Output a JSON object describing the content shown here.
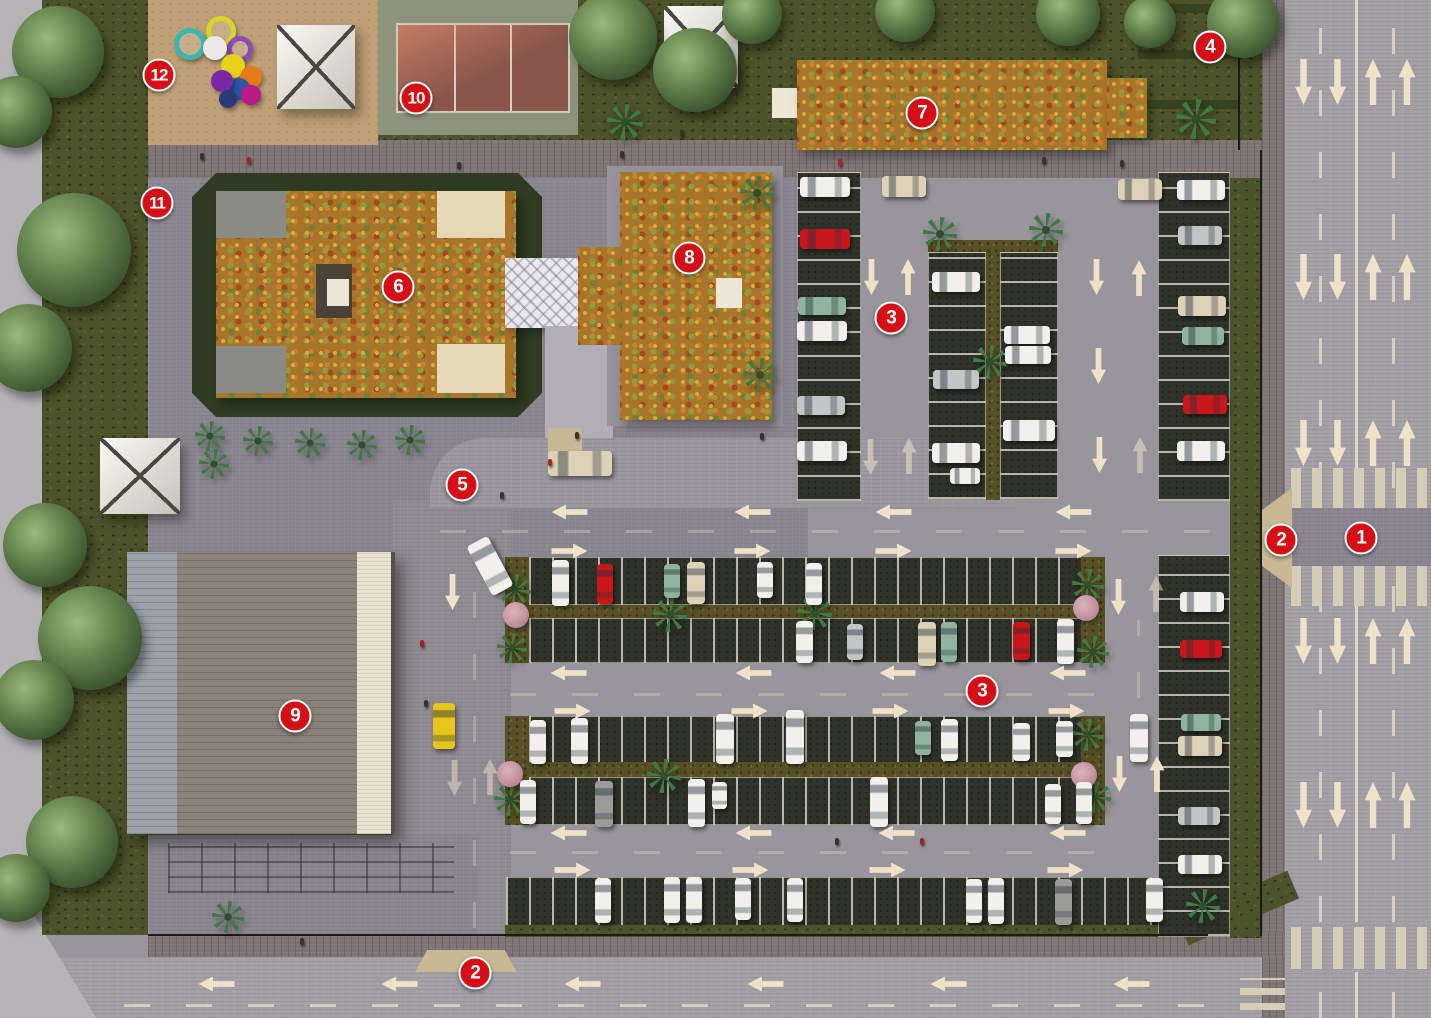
{
  "scene": {
    "width": 1431,
    "height": 1018
  },
  "colors": {
    "marker_red": "#d60e15",
    "road": "#a3a0a6",
    "plaza": "#8b8791",
    "walkway_dark": "#7d7473",
    "sidewalk_light": "#b7b4b8",
    "grass_dark": "#4c5229",
    "stall_surface": "#2f3329",
    "stall_line": "#b9b6ae",
    "arrow_cream": "#efe2c8",
    "flower_roof_base": "#a8762a",
    "building9_roof": "#8a8179",
    "canopy_white": "#efede7",
    "court_red": "#8a564b",
    "court_surround": "#8e937c",
    "sand": "#bfa077",
    "median_olive": "#575026",
    "ramp_tan": "#c9b894",
    "car_white": "#f1f0ed",
    "car_red": "#c9161a",
    "car_teal": "#8fb49f",
    "car_silver": "#c3c5c7",
    "car_gray": "#9b9b99",
    "car_beige": "#ddd2b8",
    "taxi_yellow": "#e7c51c"
  },
  "markers": [
    {
      "n": "1",
      "x": 1361,
      "y": 538
    },
    {
      "n": "2",
      "x": 1281,
      "y": 540
    },
    {
      "n": "2",
      "x": 475,
      "y": 973
    },
    {
      "n": "3",
      "x": 891,
      "y": 318
    },
    {
      "n": "3",
      "x": 982,
      "y": 691
    },
    {
      "n": "4",
      "x": 1210,
      "y": 47
    },
    {
      "n": "5",
      "x": 462,
      "y": 485
    },
    {
      "n": "6",
      "x": 398,
      "y": 287
    },
    {
      "n": "7",
      "x": 922,
      "y": 113
    },
    {
      "n": "8",
      "x": 689,
      "y": 258
    },
    {
      "n": "9",
      "x": 295,
      "y": 716
    },
    {
      "n": "10",
      "x": 416,
      "y": 98
    },
    {
      "n": "11",
      "x": 157,
      "y": 203
    },
    {
      "n": "12",
      "x": 159,
      "y": 75
    }
  ],
  "arrows": {
    "fields": [
      "dir",
      "cx",
      "cy",
      "kind",
      "opacity"
    ],
    "items": [
      [
        "down",
        1303,
        82,
        "road",
        1
      ],
      [
        "down",
        1337,
        82,
        "road",
        1
      ],
      [
        "up",
        1373,
        82,
        "road",
        1
      ],
      [
        "up",
        1407,
        82,
        "road",
        1
      ],
      [
        "down",
        1303,
        277,
        "road",
        1
      ],
      [
        "down",
        1337,
        277,
        "road",
        1
      ],
      [
        "up",
        1373,
        277,
        "road",
        1
      ],
      [
        "up",
        1407,
        277,
        "road",
        1
      ],
      [
        "down",
        1303,
        443,
        "road",
        1
      ],
      [
        "down",
        1337,
        443,
        "road",
        1
      ],
      [
        "up",
        1373,
        443,
        "road",
        1
      ],
      [
        "up",
        1407,
        443,
        "road",
        1
      ],
      [
        "down",
        1303,
        641,
        "road",
        1
      ],
      [
        "down",
        1337,
        641,
        "road",
        1
      ],
      [
        "up",
        1373,
        641,
        "road",
        1
      ],
      [
        "up",
        1407,
        641,
        "road",
        1
      ],
      [
        "down",
        1303,
        805,
        "road",
        1
      ],
      [
        "down",
        1337,
        805,
        "road",
        1
      ],
      [
        "up",
        1373,
        805,
        "road",
        1
      ],
      [
        "up",
        1407,
        805,
        "road",
        1
      ],
      [
        "left",
        216,
        984,
        "lot",
        1
      ],
      [
        "left",
        399,
        984,
        "lot",
        1
      ],
      [
        "left",
        582,
        984,
        "lot",
        1
      ],
      [
        "left",
        765,
        984,
        "lot",
        1
      ],
      [
        "left",
        948,
        984,
        "lot",
        1
      ],
      [
        "left",
        1131,
        984,
        "lot",
        1
      ],
      [
        "left",
        569,
        512,
        "lot",
        1
      ],
      [
        "left",
        752,
        512,
        "lot",
        1
      ],
      [
        "left",
        893,
        512,
        "lot",
        1
      ],
      [
        "left",
        1073,
        512,
        "lot",
        1
      ],
      [
        "right",
        569,
        551,
        "lot",
        1
      ],
      [
        "right",
        752,
        551,
        "lot",
        1
      ],
      [
        "right",
        893,
        551,
        "lot",
        1
      ],
      [
        "right",
        1073,
        551,
        "lot",
        1
      ],
      [
        "left",
        568,
        673,
        "lot",
        1
      ],
      [
        "left",
        753,
        673,
        "lot",
        1
      ],
      [
        "left",
        897,
        673,
        "lot",
        1
      ],
      [
        "left",
        1067,
        673,
        "lot",
        1
      ],
      [
        "right",
        572,
        711,
        "lot",
        1
      ],
      [
        "right",
        749,
        711,
        "lot",
        1
      ],
      [
        "right",
        890,
        711,
        "lot",
        1
      ],
      [
        "right",
        1066,
        711,
        "lot",
        1
      ],
      [
        "left",
        568,
        833,
        "lot",
        1
      ],
      [
        "left",
        753,
        833,
        "lot",
        1
      ],
      [
        "left",
        896,
        833,
        "lot",
        1
      ],
      [
        "left",
        1067,
        833,
        "lot",
        1
      ],
      [
        "right",
        572,
        870,
        "lot",
        1
      ],
      [
        "right",
        750,
        870,
        "lot",
        1
      ],
      [
        "right",
        887,
        870,
        "lot",
        1
      ],
      [
        "right",
        1065,
        870,
        "lot",
        1
      ],
      [
        "down",
        452,
        592,
        "lot",
        1
      ],
      [
        "down",
        454,
        778,
        "lot",
        0.5
      ],
      [
        "up",
        490,
        777,
        "lot",
        0.5
      ],
      [
        "down",
        871,
        277,
        "lot",
        1
      ],
      [
        "up",
        908,
        277,
        "lot",
        1
      ],
      [
        "down",
        870,
        457,
        "lot",
        0.55
      ],
      [
        "up",
        909,
        456,
        "lot",
        0.55
      ],
      [
        "down",
        1096,
        277,
        "lot",
        1
      ],
      [
        "up",
        1139,
        278,
        "lot",
        1
      ],
      [
        "down",
        1098,
        366,
        "lot",
        1
      ],
      [
        "down",
        1099,
        455,
        "lot",
        1
      ],
      [
        "up",
        1140,
        455,
        "lot",
        0.55
      ],
      [
        "down",
        1118,
        597,
        "lot",
        1
      ],
      [
        "up",
        1156,
        594,
        "lot",
        0.5
      ],
      [
        "down",
        1119,
        774,
        "lot",
        1
      ],
      [
        "up",
        1157,
        774,
        "lot",
        1
      ]
    ]
  },
  "cars": {
    "fields": [
      "x",
      "y",
      "w",
      "h",
      "color",
      "rotate"
    ],
    "items": [
      [
        800,
        177,
        50,
        20,
        "white",
        0
      ],
      [
        800,
        229,
        50,
        20,
        "red",
        0
      ],
      [
        798,
        297,
        48,
        18,
        "teal",
        0
      ],
      [
        797,
        321,
        50,
        20,
        "white",
        0
      ],
      [
        797,
        396,
        48,
        19,
        "silver",
        0
      ],
      [
        797,
        441,
        50,
        20,
        "white",
        0
      ],
      [
        932,
        272,
        48,
        20,
        "white",
        0
      ],
      [
        933,
        370,
        46,
        19,
        "silver",
        0
      ],
      [
        932,
        443,
        48,
        20,
        "white",
        0
      ],
      [
        950,
        468,
        30,
        16,
        "white",
        0
      ],
      [
        1004,
        326,
        46,
        18,
        "white",
        0
      ],
      [
        1005,
        346,
        46,
        18,
        "white",
        0
      ],
      [
        1003,
        420,
        52,
        21,
        "white",
        0
      ],
      [
        1177,
        180,
        48,
        20,
        "white",
        0
      ],
      [
        1178,
        226,
        44,
        19,
        "silver",
        0
      ],
      [
        1178,
        296,
        48,
        20,
        "beige",
        0
      ],
      [
        1182,
        327,
        42,
        18,
        "teal",
        0
      ],
      [
        1183,
        395,
        44,
        19,
        "red",
        0
      ],
      [
        1177,
        441,
        48,
        20,
        "white",
        0
      ],
      [
        882,
        176,
        44,
        21,
        "beige",
        0
      ],
      [
        1118,
        179,
        44,
        21,
        "beige",
        0
      ],
      [
        548,
        451,
        64,
        25,
        "beige",
        0
      ],
      [
        478,
        538,
        24,
        56,
        "white",
        -28
      ],
      [
        433,
        703,
        22,
        46,
        "taxi",
        0
      ],
      [
        1180,
        592,
        44,
        20,
        "white",
        0
      ],
      [
        1180,
        640,
        42,
        18,
        "red",
        0
      ],
      [
        1181,
        714,
        40,
        17,
        "teal",
        0
      ],
      [
        1178,
        736,
        44,
        20,
        "beige",
        0
      ],
      [
        1178,
        807,
        42,
        18,
        "silver",
        0
      ],
      [
        1178,
        855,
        44,
        19,
        "white",
        0
      ],
      [
        552,
        560,
        17,
        46,
        "white",
        0
      ],
      [
        597,
        564,
        16,
        40,
        "red",
        0
      ],
      [
        664,
        564,
        16,
        34,
        "teal",
        0
      ],
      [
        687,
        562,
        18,
        42,
        "beige",
        0
      ],
      [
        757,
        562,
        16,
        36,
        "white",
        0
      ],
      [
        806,
        563,
        16,
        42,
        "white",
        0
      ],
      [
        796,
        621,
        17,
        42,
        "white",
        0
      ],
      [
        847,
        624,
        16,
        36,
        "silver",
        0
      ],
      [
        918,
        622,
        18,
        44,
        "beige",
        0
      ],
      [
        941,
        622,
        16,
        40,
        "teal",
        0
      ],
      [
        1013,
        622,
        17,
        38,
        "red",
        0
      ],
      [
        1057,
        619,
        17,
        45,
        "white",
        0
      ],
      [
        530,
        720,
        16,
        44,
        "white",
        0
      ],
      [
        571,
        718,
        17,
        46,
        "white",
        0
      ],
      [
        716,
        714,
        18,
        50,
        "white",
        0
      ],
      [
        786,
        710,
        18,
        54,
        "white",
        0
      ],
      [
        915,
        721,
        16,
        34,
        "teal",
        0
      ],
      [
        941,
        719,
        17,
        42,
        "white",
        0
      ],
      [
        1013,
        723,
        17,
        38,
        "white",
        0
      ],
      [
        1056,
        721,
        17,
        36,
        "white",
        0
      ],
      [
        1130,
        714,
        18,
        48,
        "white",
        0
      ],
      [
        520,
        780,
        16,
        44,
        "white",
        0
      ],
      [
        595,
        781,
        18,
        46,
        "gray",
        0
      ],
      [
        688,
        779,
        17,
        48,
        "white",
        0
      ],
      [
        712,
        782,
        15,
        27,
        "white",
        0
      ],
      [
        870,
        777,
        18,
        50,
        "white",
        0
      ],
      [
        1045,
        784,
        16,
        40,
        "white",
        0
      ],
      [
        1076,
        782,
        16,
        42,
        "white",
        0
      ],
      [
        595,
        878,
        16,
        45,
        "white",
        0
      ],
      [
        664,
        877,
        16,
        46,
        "white",
        0
      ],
      [
        686,
        877,
        16,
        46,
        "white",
        0
      ],
      [
        735,
        878,
        16,
        42,
        "white",
        0
      ],
      [
        787,
        878,
        16,
        44,
        "white",
        0
      ],
      [
        966,
        879,
        16,
        44,
        "white",
        0
      ],
      [
        988,
        878,
        16,
        46,
        "white",
        0
      ],
      [
        1055,
        879,
        17,
        46,
        "gray",
        0
      ],
      [
        1146,
        878,
        17,
        44,
        "white",
        0
      ]
    ]
  },
  "trees": {
    "fields": [
      "cx",
      "cy",
      "r"
    ],
    "items": [
      [
        58,
        52,
        46
      ],
      [
        16,
        112,
        36
      ],
      [
        74,
        250,
        57
      ],
      [
        28,
        348,
        44
      ],
      [
        45,
        545,
        42
      ],
      [
        90,
        638,
        52
      ],
      [
        34,
        700,
        40
      ],
      [
        72,
        842,
        46
      ],
      [
        16,
        888,
        34
      ],
      [
        613,
        36,
        44
      ],
      [
        695,
        70,
        42
      ],
      [
        752,
        14,
        30
      ],
      [
        905,
        12,
        30
      ],
      [
        1068,
        14,
        32
      ],
      [
        1243,
        22,
        36
      ],
      [
        1150,
        22,
        26
      ]
    ]
  },
  "palm_trees": {
    "fields": [
      "cx",
      "cy",
      "size"
    ],
    "items": [
      [
        210,
        436,
        30
      ],
      [
        214,
        464,
        30
      ],
      [
        258,
        441,
        30
      ],
      [
        310,
        443,
        30
      ],
      [
        362,
        445,
        30
      ],
      [
        410,
        440,
        30
      ],
      [
        757,
        193,
        34
      ],
      [
        760,
        375,
        34
      ],
      [
        625,
        122,
        36
      ],
      [
        1196,
        119,
        40
      ],
      [
        940,
        234,
        34
      ],
      [
        1046,
        230,
        34
      ],
      [
        990,
        362,
        34
      ],
      [
        515,
        590,
        32
      ],
      [
        512,
        648,
        30
      ],
      [
        510,
        800,
        32
      ],
      [
        670,
        615,
        34
      ],
      [
        664,
        776,
        34
      ],
      [
        815,
        613,
        34
      ],
      [
        1088,
        585,
        32
      ],
      [
        1093,
        652,
        32
      ],
      [
        1088,
        735,
        32
      ],
      [
        1095,
        797,
        32
      ],
      [
        1203,
        906,
        34
      ],
      [
        228,
        917,
        32
      ]
    ]
  },
  "flower_bushes": {
    "fields": [
      "cx",
      "cy",
      "size"
    ],
    "items": [
      [
        516,
        615,
        26
      ],
      [
        510,
        774,
        26
      ],
      [
        1086,
        608,
        26
      ],
      [
        1084,
        775,
        26
      ]
    ]
  },
  "people": {
    "fields": [
      "x",
      "y",
      "tone"
    ],
    "items": [
      [
        200,
        153,
        "dark"
      ],
      [
        247,
        157,
        "red"
      ],
      [
        457,
        162,
        "dark"
      ],
      [
        620,
        151,
        "dark"
      ],
      [
        838,
        159,
        "red"
      ],
      [
        1042,
        157,
        "dark"
      ],
      [
        500,
        492,
        "dark"
      ],
      [
        548,
        459,
        "red"
      ],
      [
        575,
        432,
        "dark"
      ],
      [
        760,
        433,
        "dark"
      ],
      [
        420,
        640,
        "red"
      ],
      [
        424,
        700,
        "dark"
      ],
      [
        300,
        938,
        "dark"
      ],
      [
        835,
        838,
        "dark"
      ],
      [
        920,
        838,
        "red"
      ],
      [
        680,
        130,
        "dark"
      ],
      [
        1120,
        160,
        "dark"
      ]
    ]
  },
  "playground_equipment": {
    "fields": [
      "cx",
      "cy",
      "r",
      "color",
      "ring"
    ],
    "items": [
      [
        190,
        44,
        16,
        "#3bb8ae",
        true
      ],
      [
        221,
        31,
        15,
        "#d6d62a",
        true
      ],
      [
        240,
        49,
        13,
        "#8a4ab8",
        true
      ],
      [
        215,
        48,
        12,
        "#eceae6",
        false
      ],
      [
        233,
        66,
        12,
        "#e6d419",
        false
      ],
      [
        251,
        77,
        11,
        "#e87818",
        false
      ],
      [
        239,
        89,
        11,
        "#2b56a8",
        false
      ],
      [
        222,
        81,
        11,
        "#7a28a8",
        false
      ],
      [
        251,
        95,
        10,
        "#b81a88",
        false
      ],
      [
        228,
        99,
        9,
        "#2a3a78",
        false
      ]
    ]
  }
}
